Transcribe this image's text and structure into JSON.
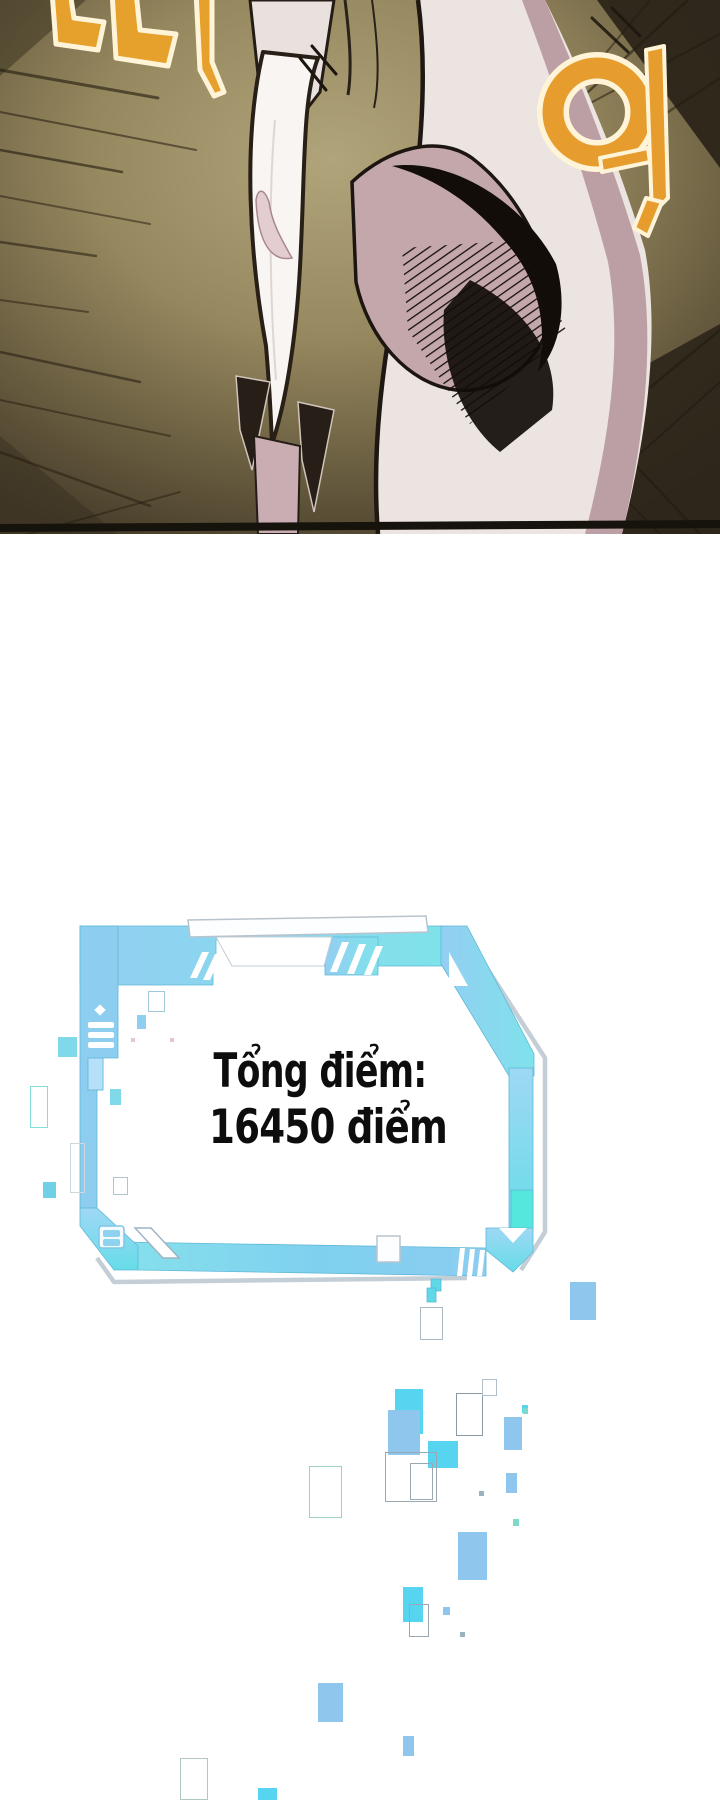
{
  "page": {
    "width": 720,
    "height": 1800,
    "background": "#ffffff"
  },
  "comic_panel": {
    "background_center": "#b0a47b",
    "background_edge": "#453b28",
    "border_color": "#16120c",
    "sfx": [
      {
        "text": "따",
        "meaning": "snap-sfx",
        "color": "#e6a02c",
        "outline": "#fff4d8"
      },
      {
        "text": "악",
        "meaning": "shout-sfx",
        "color": "#e69d2e",
        "outline": "#fff4d8"
      }
    ]
  },
  "status_window": {
    "line1": "Tổng điểm:",
    "line2": "16450 điểm",
    "text_color": "#0d0d0d",
    "frame_color_light": "#aee6f5",
    "frame_color": "#7fd6ef",
    "frame_color_blue": "#8ccdf0",
    "frame_accent": "#55e6de",
    "outline_color": "#c4ced6"
  },
  "particles": [
    {
      "x": 58,
      "y": 1037,
      "w": 19,
      "h": 20,
      "fill": "#7fd9e8"
    },
    {
      "x": 137,
      "y": 1015,
      "w": 9,
      "h": 14,
      "fill": "#8ecef0"
    },
    {
      "x": 148,
      "y": 991,
      "w": 17,
      "h": 21,
      "stroke": "#9fc9d8"
    },
    {
      "x": 110,
      "y": 1089,
      "w": 11,
      "h": 16,
      "fill": "#7fd9e8"
    },
    {
      "x": 30,
      "y": 1086,
      "w": 18,
      "h": 42,
      "stroke": "#86dcd8"
    },
    {
      "x": 70,
      "y": 1143,
      "w": 15,
      "h": 50,
      "stroke": "#ccd8de"
    },
    {
      "x": 113,
      "y": 1177,
      "w": 15,
      "h": 18,
      "stroke": "#b0c4d0"
    },
    {
      "x": 43,
      "y": 1182,
      "w": 13,
      "h": 16,
      "fill": "#6fd0e8"
    },
    {
      "x": 131,
      "y": 1038,
      "w": 4,
      "h": 4,
      "fill": "#e6c6d2"
    },
    {
      "x": 170,
      "y": 1038,
      "w": 4,
      "h": 4,
      "fill": "#e6c6d2"
    },
    {
      "x": 570,
      "y": 1282,
      "w": 26,
      "h": 38,
      "fill": "#8ec6ee"
    },
    {
      "x": 420,
      "y": 1307,
      "w": 23,
      "h": 33,
      "stroke": "#aab8c4"
    },
    {
      "x": 395,
      "y": 1389,
      "w": 28,
      "h": 45,
      "fill": "#57d4ef"
    },
    {
      "x": 388,
      "y": 1410,
      "w": 32,
      "h": 45,
      "fill": "#8ec6ee"
    },
    {
      "x": 456,
      "y": 1393,
      "w": 27,
      "h": 43,
      "stroke": "#8a9aa4"
    },
    {
      "x": 482,
      "y": 1379,
      "w": 15,
      "h": 17,
      "stroke": "#b0c0cc"
    },
    {
      "x": 504,
      "y": 1417,
      "w": 18,
      "h": 33,
      "fill": "#8ec6ee"
    },
    {
      "x": 522,
      "y": 1405,
      "w": 6,
      "h": 8,
      "fill": "#57d4ef"
    },
    {
      "x": 428,
      "y": 1441,
      "w": 30,
      "h": 27,
      "fill": "#57d4ef"
    },
    {
      "x": 385,
      "y": 1452,
      "w": 52,
      "h": 50,
      "stroke": "#9aa8b2"
    },
    {
      "x": 410,
      "y": 1463,
      "w": 23,
      "h": 37,
      "stroke": "#9aa8b2"
    },
    {
      "x": 309,
      "y": 1466,
      "w": 33,
      "h": 52,
      "stroke": "#9fd0c0"
    },
    {
      "x": 506,
      "y": 1473,
      "w": 11,
      "h": 20,
      "fill": "#8ec6ee"
    },
    {
      "x": 523,
      "y": 1408,
      "w": 5,
      "h": 6,
      "fill": "#7fd9c8"
    },
    {
      "x": 479,
      "y": 1491,
      "w": 5,
      "h": 5,
      "fill": "#9ab4be"
    },
    {
      "x": 513,
      "y": 1519,
      "w": 6,
      "h": 7,
      "fill": "#7fd9c8"
    },
    {
      "x": 458,
      "y": 1532,
      "w": 29,
      "h": 48,
      "fill": "#8ec6ee"
    },
    {
      "x": 403,
      "y": 1587,
      "w": 20,
      "h": 35,
      "fill": "#57d4ef"
    },
    {
      "x": 409,
      "y": 1604,
      "w": 20,
      "h": 33,
      "stroke": "#9aa8b2"
    },
    {
      "x": 443,
      "y": 1607,
      "w": 7,
      "h": 8,
      "fill": "#8ec6ee"
    },
    {
      "x": 460,
      "y": 1632,
      "w": 5,
      "h": 5,
      "fill": "#9ab4be"
    },
    {
      "x": 318,
      "y": 1683,
      "w": 25,
      "h": 39,
      "fill": "#8ec6ee"
    },
    {
      "x": 403,
      "y": 1736,
      "w": 11,
      "h": 20,
      "fill": "#8ec6ee"
    },
    {
      "x": 180,
      "y": 1758,
      "w": 28,
      "h": 42,
      "stroke": "#b0c8c0"
    },
    {
      "x": 258,
      "y": 1788,
      "w": 19,
      "h": 12,
      "fill": "#57d4ef"
    }
  ]
}
